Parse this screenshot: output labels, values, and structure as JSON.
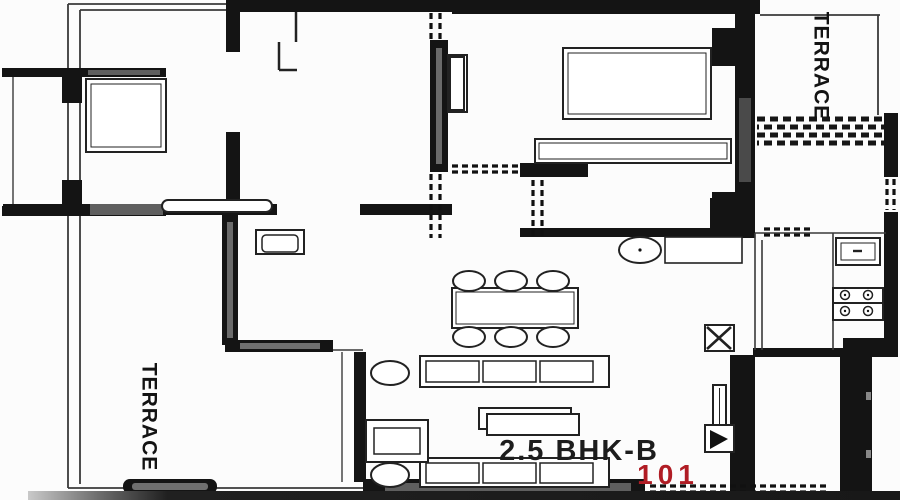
{
  "plan": {
    "unit_type": "2.5 BHK-B",
    "unit_number": "101",
    "terrace_top_right": "TERRACE",
    "terrace_bottom_left": "TERRACE"
  },
  "colors": {
    "wall": "#141414",
    "text_black": "#1c1c1c",
    "unit_number_red": "#b01c24",
    "window_gray": "#5f5f5f"
  }
}
